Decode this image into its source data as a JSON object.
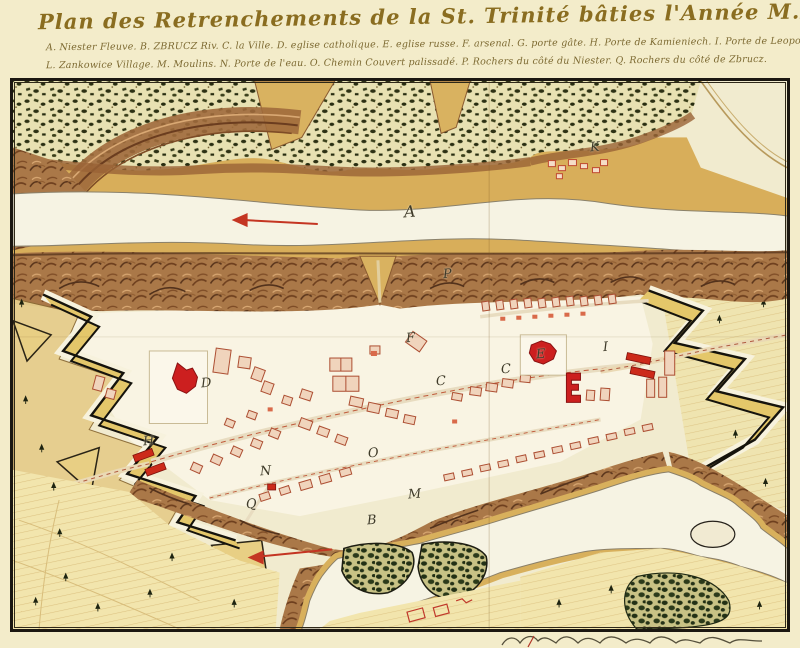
{
  "title": "Plan des Retrenchements de la St. Trinité bâties l'Année M.D.C.L.X.IV.",
  "legend": {
    "line1": "A. Niester Fleuve.  B. ZBRUCZ Riv.  C. la Ville.  D. eglise catholique.  E. eglise russe.  F. arsenal.  G. porte gâte.  H. Porte de Kamieniech.  I. Porte de Leopol.  K. Przypodok village.",
    "line2": "L. Zankowice Village.  M. Moulins.  N. Porte de l'eau.  O. Chemin Couvert palissadé.  P. Rochers du côté du Niester.  Q. Rochers du côté de Zbrucz."
  },
  "markers": [
    {
      "letter": "A"
    },
    {
      "letter": "B"
    },
    {
      "letter": "C"
    },
    {
      "letter": "C"
    },
    {
      "letter": "D"
    },
    {
      "letter": "E"
    },
    {
      "letter": "F"
    },
    {
      "letter": "H"
    },
    {
      "letter": "I"
    },
    {
      "letter": "K"
    },
    {
      "letter": "M"
    },
    {
      "letter": "N"
    },
    {
      "letter": "O"
    },
    {
      "letter": "P"
    },
    {
      "letter": "Q"
    }
  ],
  "icons": {
    "river_flow_arrow": "left-pointing red arrow",
    "tree_symbol": "small spruce glyph"
  },
  "colors": {
    "parchment": "#f3ecca",
    "ink_title": "#8a6d20",
    "building_red": "#cc2a1a",
    "rampart_yellow": "#e4c76a",
    "cliff_brown": "#aa7848",
    "forest_green": "#2d3114",
    "river": "#f6f3e3",
    "field_yellow": "#f2e5ad",
    "arrow_red": "#c43522"
  }
}
